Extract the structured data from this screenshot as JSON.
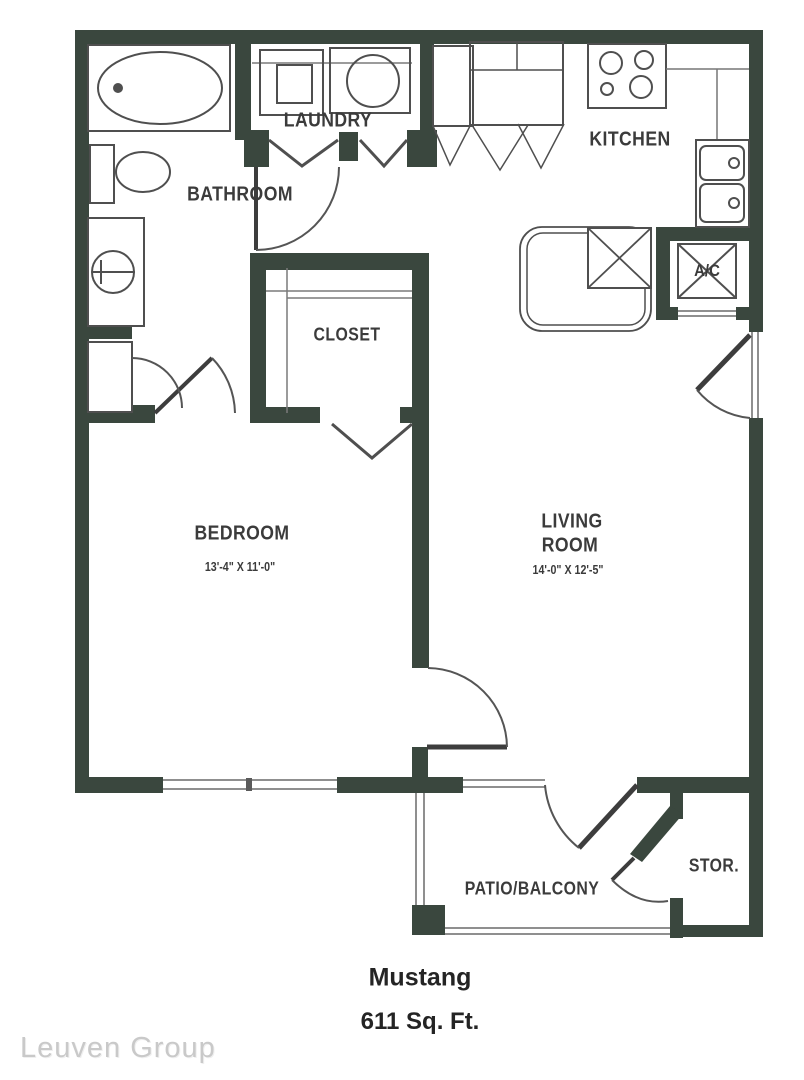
{
  "plan": {
    "rooms": {
      "bathroom": {
        "label": "BATHROOM"
      },
      "laundry": {
        "label": "LAUNDRY"
      },
      "kitchen": {
        "label": "KITCHEN"
      },
      "closet": {
        "label": "CLOSET"
      },
      "bedroom": {
        "label": "BEDROOM",
        "dimensions": "13'-4\" X 11'-0\""
      },
      "living_room": {
        "label_line1": "LIVING",
        "label_line2": "ROOM",
        "dimensions": "14'-0\" X 12'-5\""
      },
      "ac_closet": {
        "label": "A/C"
      },
      "storage": {
        "label": "STOR."
      },
      "patio": {
        "label": "PATIO/BALCONY"
      }
    },
    "colors": {
      "wall": "#3a473e",
      "fixture_line": "#4f4f4f",
      "thin_line": "#999999",
      "text": "#3b3b3b"
    }
  },
  "footer": {
    "plan_name": "Mustang",
    "area": "611 Sq. Ft."
  },
  "watermark": {
    "text": "Leuven Group"
  }
}
